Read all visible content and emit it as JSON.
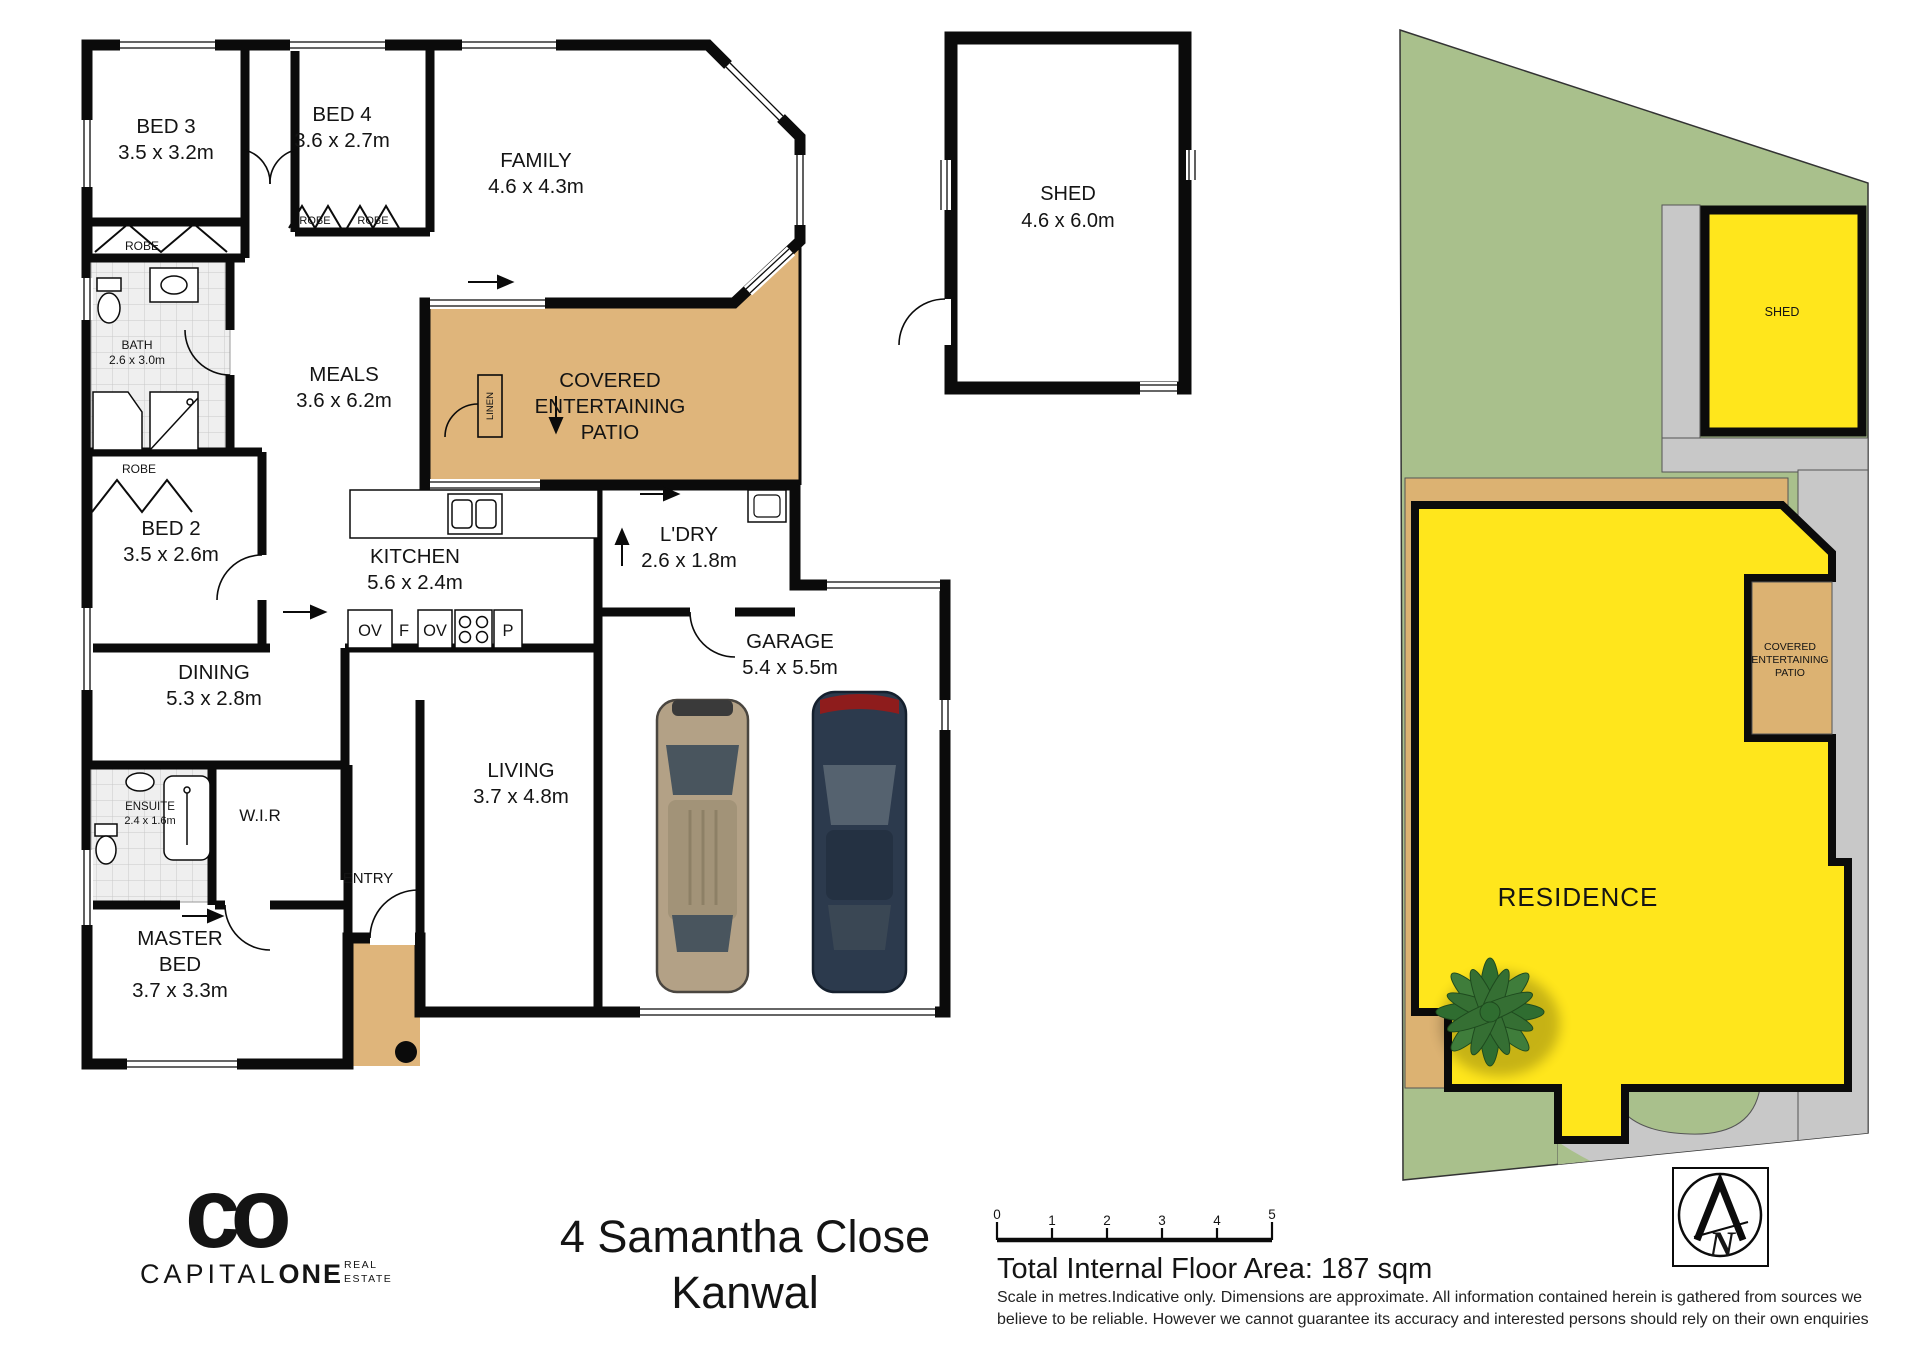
{
  "colors": {
    "wall": "#0b0b0b",
    "patio_tan": "#dfb57b",
    "site_green": "#a9c08c",
    "site_gray": "#c8c8c8",
    "site_yellow": "#ffe61c",
    "logo_navy": "#2c3046"
  },
  "floor_plan": {
    "bed3": {
      "label": "BED 3",
      "dims": "3.5 x 3.2m"
    },
    "bed4": {
      "label": "BED 4",
      "dims": "3.6 x 2.7m"
    },
    "family": {
      "label": "FAMILY",
      "dims": "4.6 x 4.3m"
    },
    "meals": {
      "label": "MEALS",
      "dims": "3.6 x 6.2m"
    },
    "bed2": {
      "label": "BED 2",
      "dims": "3.5 x 2.6m"
    },
    "bath": {
      "label": "BATH",
      "dims": "2.6 x 3.0m"
    },
    "kitchen": {
      "label": "KITCHEN",
      "dims": "5.6 x 2.4m"
    },
    "laundry": {
      "label": "L'DRY",
      "dims": "2.6 x 1.8m"
    },
    "dining": {
      "label": "DINING",
      "dims": "5.3 x 2.8m"
    },
    "garage": {
      "label": "GARAGE",
      "dims": "5.4 x 5.5m"
    },
    "living": {
      "label": "LIVING",
      "dims": "3.7 x 4.8m"
    },
    "master": {
      "line1": "MASTER",
      "line2": "BED",
      "dims": "3.7 x 3.3m"
    },
    "ensuite": {
      "label": "ENSUITE",
      "dims": "2.4 x 1.6m"
    },
    "wir": {
      "label": "W.I.R"
    },
    "entry": {
      "label": "ENTRY"
    },
    "patio": {
      "line1": "COVERED",
      "line2": "ENTERTAINING",
      "line3": "PATIO"
    },
    "robe": "ROBE",
    "linen": "LINEN",
    "appliances": {
      "oven1": "OV",
      "fridge": "F",
      "oven2": "OV",
      "pantry": "P"
    }
  },
  "shed_plan": {
    "label": "SHED",
    "dims": "4.6 x 6.0m"
  },
  "site_plan": {
    "shed": "SHED",
    "residence": "RESIDENCE",
    "patio": {
      "line1": "COVERED",
      "line2": "ENTERTAINING",
      "line3": "PATIO"
    }
  },
  "compass": {
    "north": "N"
  },
  "scale_bar": {
    "ticks": [
      "0",
      "1",
      "2",
      "3",
      "4",
      "5"
    ]
  },
  "footer": {
    "address_line1": "4 Samantha Close",
    "address_line2": "Kanwal",
    "floor_area": "Total Internal Floor Area: 187 sqm",
    "disclaimer1": "Scale in metres.Indicative only. Dimensions are approximate. All information contained herein is gathered from sources we",
    "disclaimer2": "believe to be reliable. However we cannot guarantee its accuracy and interested persons should rely on their own enquiries"
  },
  "logo": {
    "monogram": "co",
    "brand_a": "CAPITAL",
    "brand_b": "ONE",
    "tag1": "REAL",
    "tag2": "ESTATE"
  }
}
